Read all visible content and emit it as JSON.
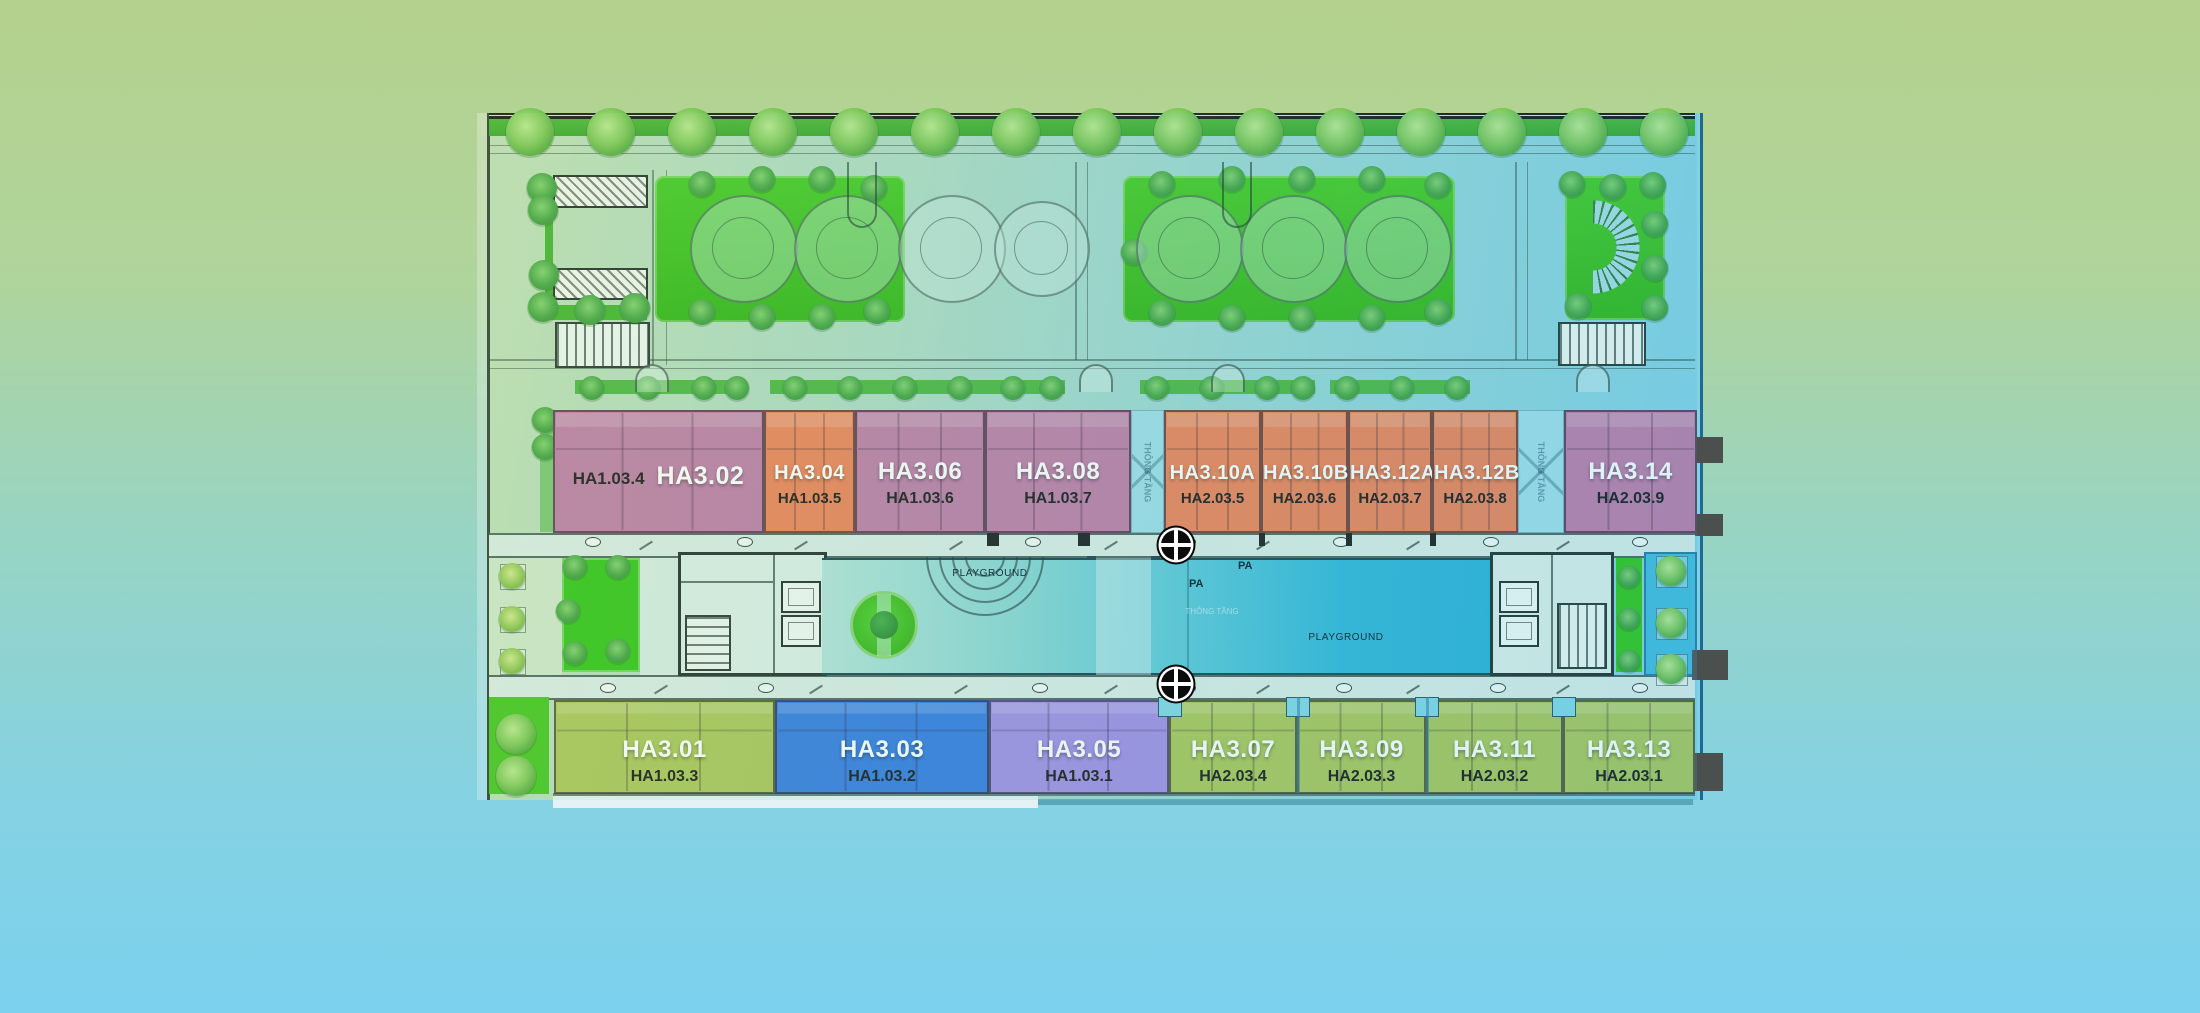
{
  "plan": {
    "type": "residential-floor-plan",
    "void_label": "THÔNG TẦNG",
    "playground_label_left": "PLAYGROUND",
    "playground_label_right": "PLAYGROUND",
    "pa_label_1": "PA",
    "pa_label_2": "PA"
  },
  "units": {
    "top": [
      {
        "name": "HA3.02",
        "sub": "HA1.03.4",
        "color": "#bd7aa6"
      },
      {
        "name": "HA3.04",
        "sub": "HA1.03.5",
        "color": "#ee8054"
      },
      {
        "name": "HA3.06",
        "sub": "HA1.03.6",
        "color": "#bd7aa6"
      },
      {
        "name": "HA3.08",
        "sub": "HA1.03.7",
        "color": "#bd7aa6"
      },
      {
        "name": "HA3.10A",
        "sub": "HA2.03.5",
        "color": "#ee8054"
      },
      {
        "name": "HA3.10B",
        "sub": "HA2.03.6",
        "color": "#ee8054"
      },
      {
        "name": "HA3.12A",
        "sub": "HA2.03.7",
        "color": "#ee8054"
      },
      {
        "name": "HA3.12B",
        "sub": "HA2.03.8",
        "color": "#ee8054"
      },
      {
        "name": "HA3.14",
        "sub": "HA2.03.9",
        "color": "#bd7aa6"
      }
    ],
    "bottom": [
      {
        "name": "HA3.01",
        "sub": "HA1.03.3",
        "color": "#a9c556"
      },
      {
        "name": "HA3.03",
        "sub": "HA1.03.2",
        "color": "#3079e2"
      },
      {
        "name": "HA3.05",
        "sub": "HA1.03.1",
        "color": "#a08ce6"
      },
      {
        "name": "HA3.07",
        "sub": "HA2.03.4",
        "color": "#a9c556"
      },
      {
        "name": "HA3.09",
        "sub": "HA2.03.3",
        "color": "#a9c556"
      },
      {
        "name": "HA3.11",
        "sub": "HA2.03.2",
        "color": "#a9c556"
      },
      {
        "name": "HA3.13",
        "sub": "HA2.03.1",
        "color": "#a9c556"
      }
    ]
  },
  "colors": {
    "pink_unit": "#bd7aa6",
    "orange_unit": "#ee8054",
    "green_unit": "#a9c556",
    "blue_unit": "#3079e2",
    "purple_unit": "#a08ce6",
    "pool": "#2fb6d9",
    "lawn": "#2ec414",
    "background_top": "#b4d28d",
    "background_bottom": "#7cd1ee"
  }
}
